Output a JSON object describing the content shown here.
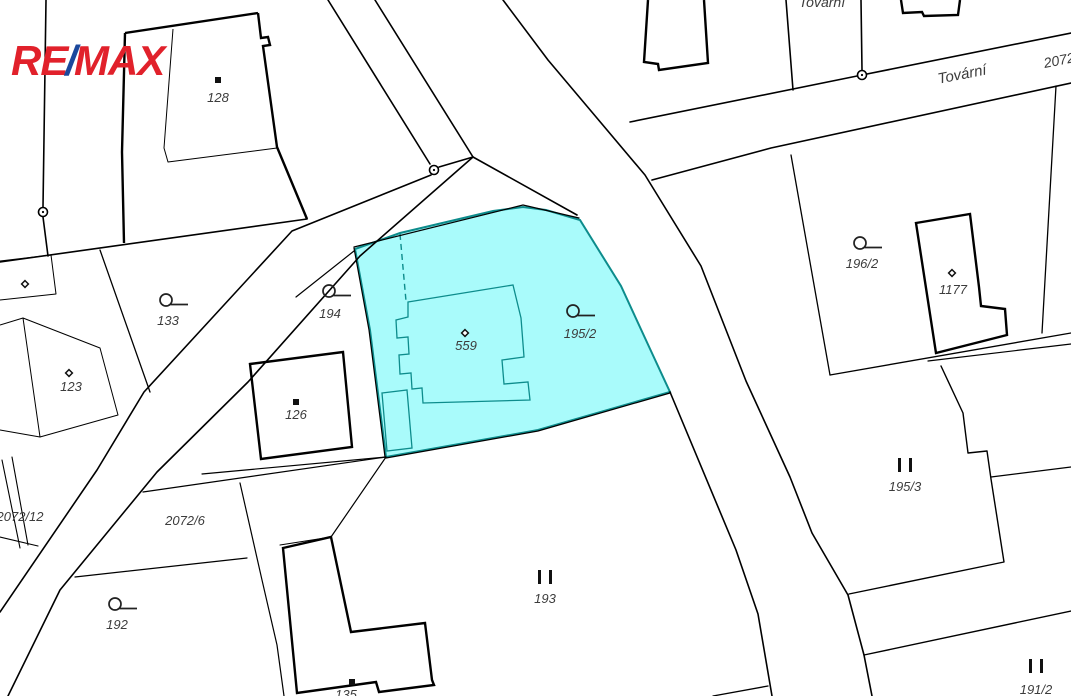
{
  "logo": {
    "text_re": "RE",
    "text_slash": "/",
    "text_max": "MAX",
    "color_red": "#E1212B",
    "color_blue": "#1B489C"
  },
  "map": {
    "type": "cadastral-map",
    "background": "#FFFFFF",
    "line_color": "#000000",
    "highlight": {
      "fill": "#A9FBFB",
      "stroke": "#0D8C8C",
      "highlighted_parcels": [
        "559",
        "195/2"
      ]
    },
    "street_label_color": "#3c3c3c",
    "labels": [
      {
        "text": "128",
        "x": 218,
        "y": 102,
        "size": 13,
        "rot": 0
      },
      {
        "text": "133",
        "x": 168,
        "y": 325,
        "size": 13,
        "rot": 0
      },
      {
        "text": "123",
        "x": 71,
        "y": 391,
        "size": 13,
        "rot": 0
      },
      {
        "text": "194",
        "x": 330,
        "y": 318,
        "size": 13,
        "rot": 0
      },
      {
        "text": "126",
        "x": 296,
        "y": 419,
        "size": 13,
        "rot": 0
      },
      {
        "text": "559",
        "x": 466,
        "y": 350,
        "size": 13,
        "rot": 0
      },
      {
        "text": "195/2",
        "x": 580,
        "y": 338,
        "size": 13,
        "rot": 0
      },
      {
        "text": "196/2",
        "x": 862,
        "y": 268,
        "size": 13,
        "rot": 0
      },
      {
        "text": "1177",
        "x": 953,
        "y": 294,
        "size": 13,
        "rot": 0
      },
      {
        "text": "195/3",
        "x": 905,
        "y": 491,
        "size": 13,
        "rot": 0
      },
      {
        "text": "193",
        "x": 545,
        "y": 603,
        "size": 13,
        "rot": 0
      },
      {
        "text": "192",
        "x": 117,
        "y": 629,
        "size": 13,
        "rot": 0
      },
      {
        "text": "2072/6",
        "x": 185,
        "y": 525,
        "size": 13,
        "rot": 0
      },
      {
        "text": "2072/12",
        "x": 20,
        "y": 521,
        "size": 13,
        "rot": 0
      },
      {
        "text": "135",
        "x": 346,
        "y": 699,
        "size": 13,
        "rot": 0
      },
      {
        "text": "191/2",
        "x": 1036,
        "y": 694,
        "size": 13,
        "rot": 0
      },
      {
        "text": "Tovární",
        "x": 963,
        "y": 79,
        "size": 15,
        "rot": -11
      },
      {
        "text": "2072",
        "x": 1060,
        "y": 65,
        "size": 14,
        "rot": -11
      },
      {
        "text": "Tovární",
        "x": 822,
        "y": 7,
        "size": 14,
        "rot": 0
      }
    ],
    "symbols": [
      {
        "type": "square",
        "x": 218,
        "y": 80
      },
      {
        "type": "circle-tail",
        "x": 166,
        "y": 300
      },
      {
        "type": "diamond",
        "x": 69,
        "y": 373
      },
      {
        "type": "circle-tail",
        "x": 329,
        "y": 291
      },
      {
        "type": "square",
        "x": 296,
        "y": 402
      },
      {
        "type": "diamond",
        "x": 465,
        "y": 333
      },
      {
        "type": "circle-tail",
        "x": 573,
        "y": 311
      },
      {
        "type": "circle-tail",
        "x": 860,
        "y": 243
      },
      {
        "type": "diamond",
        "x": 952,
        "y": 273
      },
      {
        "type": "double-bar",
        "x": 905,
        "y": 465
      },
      {
        "type": "double-bar",
        "x": 545,
        "y": 577
      },
      {
        "type": "circle-tail",
        "x": 115,
        "y": 604
      },
      {
        "type": "square",
        "x": 352,
        "y": 682
      },
      {
        "type": "double-bar",
        "x": 1036,
        "y": 666
      },
      {
        "type": "diamond",
        "x": 25,
        "y": 284
      }
    ],
    "junction_points": [
      {
        "x": 434,
        "y": 170
      },
      {
        "x": 862,
        "y": 75
      },
      {
        "x": 43,
        "y": 212
      }
    ]
  }
}
